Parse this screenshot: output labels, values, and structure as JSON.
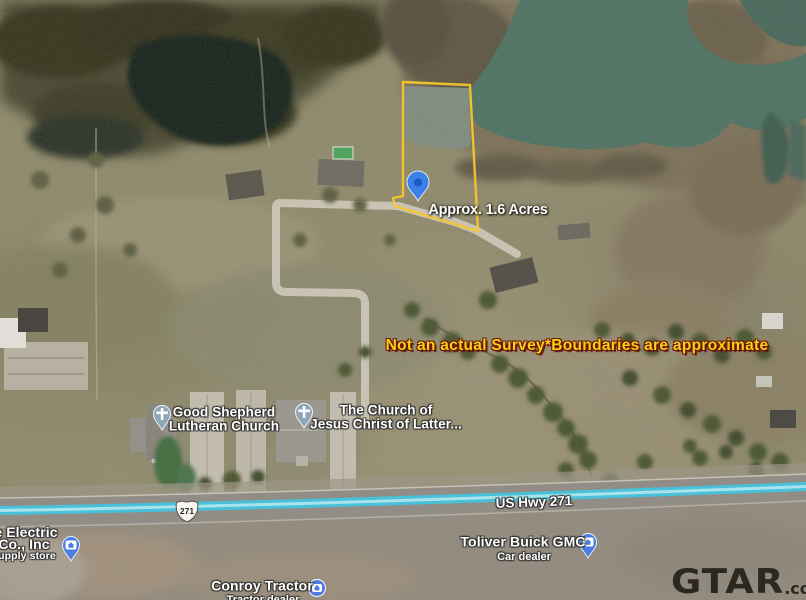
{
  "annotations": {
    "acreage": "Approx. 1.6 Acres",
    "disclaimer": "Not an actual Survey*Boundaries are approximate"
  },
  "pois": {
    "church1": {
      "line1": "Good Shepherd",
      "line2": "Lutheran Church"
    },
    "church2": {
      "line1": "The Church of",
      "line2": "Jesus Christ of Latter..."
    },
    "electric": {
      "line1": "le Electric",
      "line2": "Co., Inc",
      "line3": "supply store"
    },
    "tractor": {
      "name": "Conroy Tractor",
      "type": "Tractor dealer"
    },
    "dealer": {
      "name": "Toliver Buick GMC",
      "type": "Car dealer"
    }
  },
  "highway": {
    "name": "US Hwy 271",
    "shield": "271"
  },
  "watermark": {
    "brand": "GTAR",
    "suffix": ".com"
  },
  "icons": {
    "property_pin": "blue-map-pin",
    "church_pins": "gray-pin-with-cross",
    "store_pins": "blue-pin-with-briefcase",
    "store_dot": "blue-circle-briefcase",
    "route_shield": "us-highway-shield"
  },
  "colors": {
    "boundary": "#F6C62E",
    "disclaimer_text": "#F0D315",
    "highway_line": "#3FC3DF",
    "pin_blue": "#3E80E8",
    "pond_green": "#4D7263"
  }
}
